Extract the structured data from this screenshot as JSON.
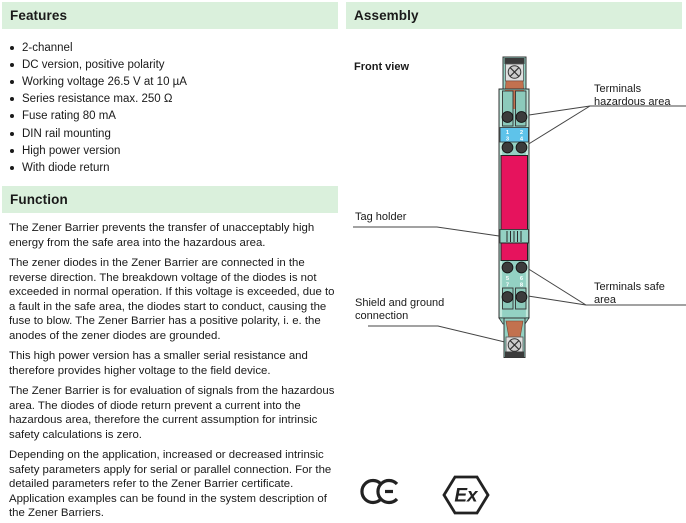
{
  "features": {
    "title": "Features",
    "items": [
      "2-channel",
      "DC version, positive polarity",
      "Working voltage 26.5 V at 10 µA",
      "Series resistance max. 250 Ω",
      "Fuse rating 80 mA",
      "DIN rail mounting",
      "High power version",
      "With diode return"
    ]
  },
  "function": {
    "title": "Function",
    "paragraphs": [
      "The Zener Barrier prevents the transfer of unacceptably high energy from the safe area into the hazardous area.",
      "The zener diodes in the Zener Barrier are connected in the reverse direction. The breakdown voltage of the diodes is not exceeded in normal operation. If this voltage is exceeded, due to a fault in the safe area, the diodes start to conduct, causing the fuse to blow. The Zener Barrier has a positive polarity, i. e. the anodes of the zener diodes are grounded.",
      "This high power version has a smaller serial resistance and therefore provides higher voltage to the field device.",
      "The Zener Barrier is for evaluation of signals from the hazardous area. The diodes of diode return prevent a current into the hazardous area, therefore the current assumption for intrinsic safety calculations is zero.",
      "Depending on the application, increased or decreased intrinsic safety parameters apply for serial or parallel connection. For the detailed parameters refer to the Zener Barrier certificate. Application examples can be found in the system description of the Zener Barriers."
    ]
  },
  "assembly": {
    "title": "Assembly",
    "front_view_label": "Front view",
    "callouts": {
      "terminals_hazardous": "Terminals hazardous area",
      "tag_holder": "Tag holder",
      "shield_ground": "Shield and ground connection",
      "terminals_safe": "Terminals safe area"
    },
    "terminal_numbers": [
      "1",
      "2",
      "3",
      "4",
      "5",
      "6",
      "7",
      "8"
    ],
    "certification": {
      "ce_mark": "CE",
      "ex_mark": "Ex"
    }
  },
  "colors": {
    "section_bar_green": "#daf0dc",
    "device_teal": "#93d1c3",
    "device_rail_teal": "#c2e8dc",
    "slot_teal": "#8ccabb",
    "label_band_blue": "#5ec3ea",
    "front_panel_magenta": "#e6135d",
    "mount_orange": "#c2714f",
    "terminal_screw_gray": "#3c3c3c"
  }
}
